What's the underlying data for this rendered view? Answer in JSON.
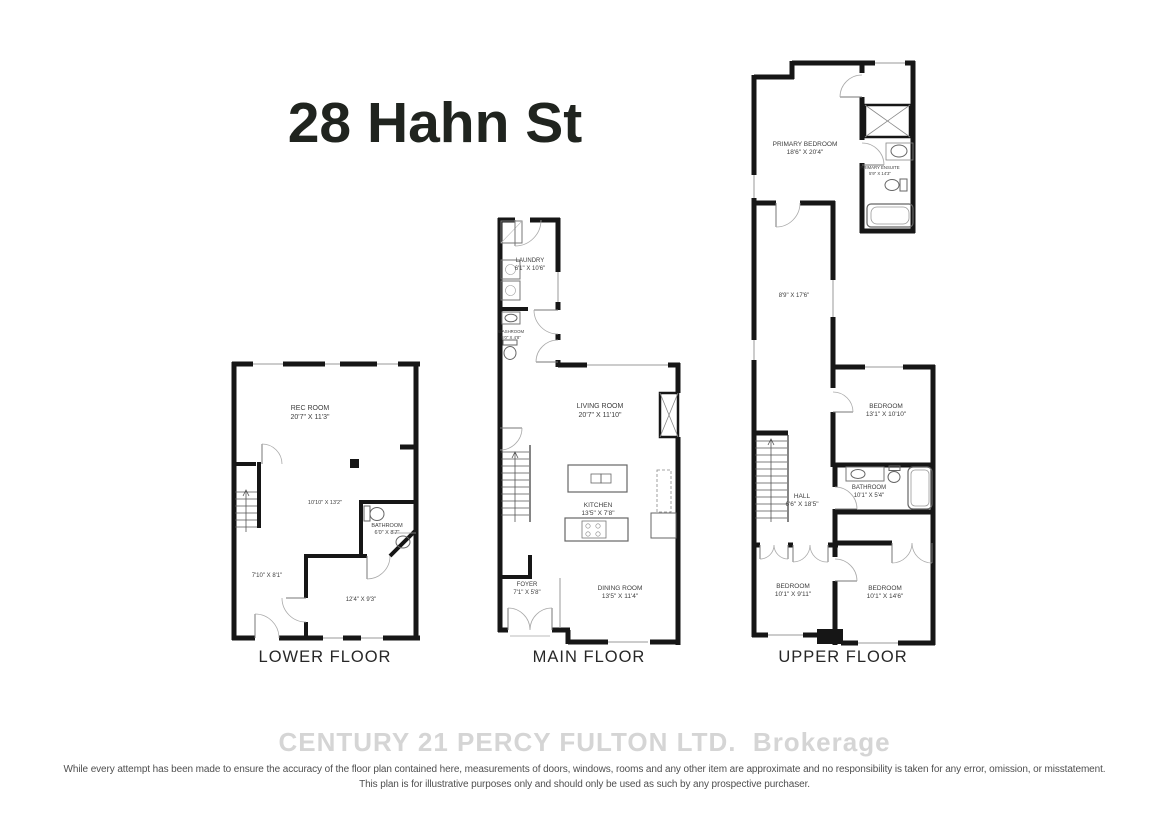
{
  "title": "28 Hahn St",
  "floors": {
    "lower": {
      "label": "LOWER FLOOR",
      "rec_room": {
        "name": "REC ROOM",
        "dims": "20'7\" X 11'3\""
      },
      "open_area": {
        "dims": "10'10\" X 13'2\""
      },
      "bathroom": {
        "name": "BATHROOM",
        "dims": "6'0\" X 8'7\""
      },
      "den_area": {
        "dims": "7'10\" X 8'1\""
      },
      "rear_room": {
        "dims": "12'4\" X 9'3\""
      }
    },
    "main": {
      "label": "MAIN FLOOR",
      "laundry": {
        "name": "LAUNDRY",
        "dims": "6'1\" X 10'6\""
      },
      "washroom": {
        "name": "WASHROOM",
        "dims": "5'0\" X 4'8\""
      },
      "living_room": {
        "name": "LIVING ROOM",
        "dims": "20'7\" X 11'10\""
      },
      "kitchen": {
        "name": "KITCHEN",
        "dims": "13'5\" X 7'8\""
      },
      "foyer": {
        "name": "FOYER",
        "dims": "7'1\" X 5'8\""
      },
      "dining_room": {
        "name": "DINING ROOM",
        "dims": "13'5\" X 11'4\""
      }
    },
    "upper": {
      "label": "UPPER FLOOR",
      "primary_bedroom": {
        "name": "PRIMARY BEDROOM",
        "dims": "18'6\" X 20'4\""
      },
      "primary_ensuite": {
        "name": "PRIMARY ENSUITE",
        "dims": "5'9\" X 14'3\""
      },
      "sitting_area": {
        "dims": "8'9\" X 17'6\""
      },
      "bedroom2": {
        "name": "BEDROOM",
        "dims": "13'1\" X 10'10\""
      },
      "hall": {
        "name": "HALL",
        "dims": "6'6\" X 18'5\""
      },
      "bathroom": {
        "name": "BATHROOM",
        "dims": "10'1\" X 5'4\""
      },
      "bedroom3": {
        "name": "BEDROOM",
        "dims": "10'1\" X 9'11\""
      },
      "bedroom4": {
        "name": "BEDROOM",
        "dims": "10'1\" X 14'6\""
      }
    }
  },
  "watermark": "CENTURY 21 PERCY FULTON LTD.  Brokerage",
  "disclaimer_line1": "While every attempt has been made to ensure the accuracy of the floor plan contained here, measurements of doors, windows, rooms and any other item are approximate and no responsibility is taken for any error, omission, or misstatement.",
  "disclaimer_line2": "This plan is for illustrative purposes only and should only be used as such by any prospective purchaser.",
  "colors": {
    "wall": "#161616",
    "thin_line": "#999999",
    "label_text": "#3d3d3d",
    "watermark": "#d5d5d5"
  }
}
